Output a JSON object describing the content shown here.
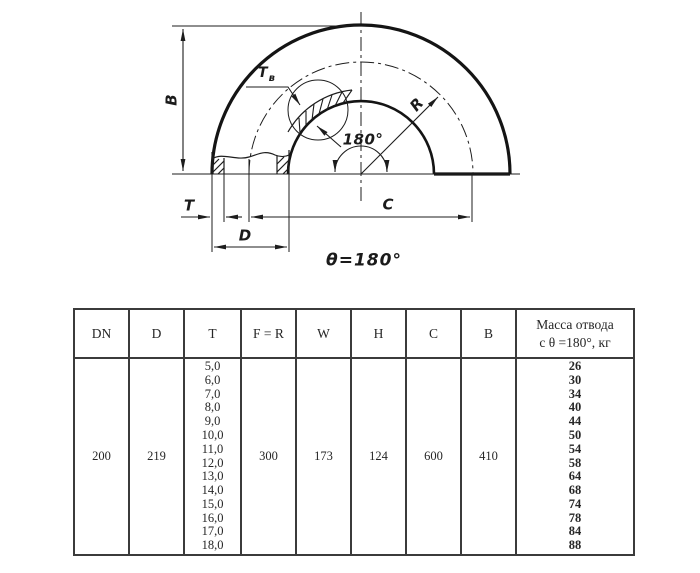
{
  "drawing": {
    "labels": {
      "b": "B",
      "t": "T",
      "d": "D",
      "c": "C",
      "r": "R",
      "tv_main": "T",
      "tv_sub": "в",
      "angle": "180°",
      "theta": "θ=180°"
    }
  },
  "table": {
    "headers": [
      "DN",
      "D",
      "T",
      "F = R",
      "W",
      "H",
      "C",
      "B",
      "Масса отвода\nс θ =180°, кг"
    ],
    "row": {
      "dn": "200",
      "d": "219",
      "t_values": [
        "5,0",
        "6,0",
        "7,0",
        "8,0",
        "9,0",
        "10,0",
        "11,0",
        "12,0",
        "13,0",
        "14,0",
        "15,0",
        "16,0",
        "17,0",
        "18,0"
      ],
      "f_r": "300",
      "w": "173",
      "h": "124",
      "c": "600",
      "b": "410",
      "mass_values": [
        "26",
        "30",
        "34",
        "40",
        "44",
        "50",
        "54",
        "58",
        "64",
        "68",
        "74",
        "78",
        "84",
        "88"
      ]
    }
  },
  "colors": {
    "line": "#1d1d1d",
    "table_border": "#3b3b3b",
    "mass_text": "#363c5e"
  }
}
